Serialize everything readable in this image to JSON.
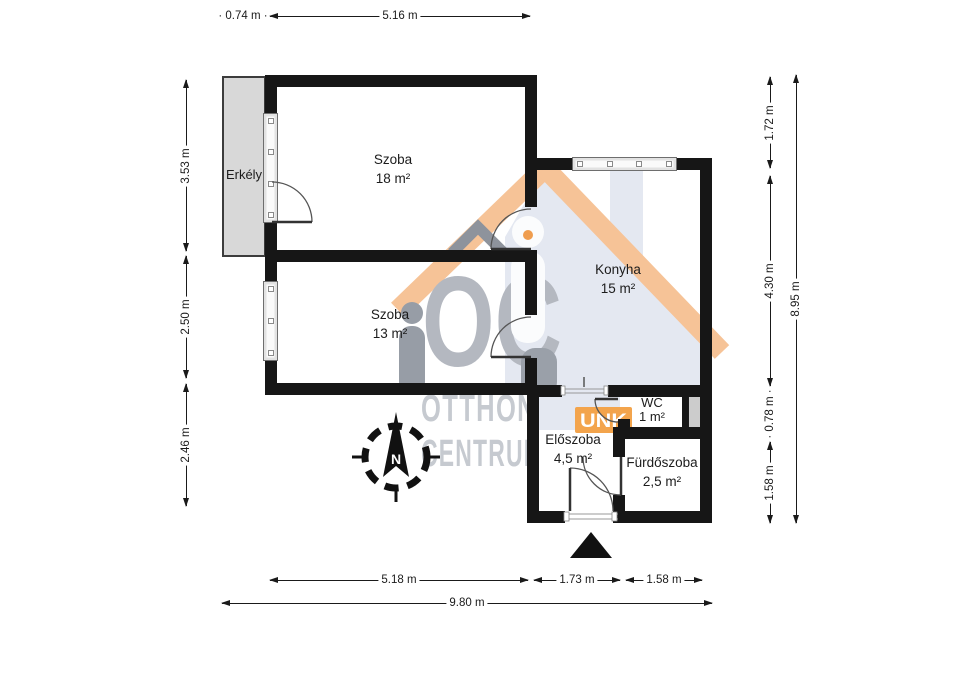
{
  "floorplan": {
    "rooms": [
      {
        "name": "Szoba",
        "area": "18 m²"
      },
      {
        "name": "Szoba",
        "area": "13 m²"
      },
      {
        "name": "Konyha",
        "area": "15 m²"
      },
      {
        "name": "WC",
        "area": "1 m²"
      },
      {
        "name": "Előszoba",
        "area": "4,5 m²"
      },
      {
        "name": "Fürdőszoba",
        "area": "2,5 m²"
      }
    ],
    "balcony_label": "Erkély",
    "compass_north": "N"
  },
  "dimensions": {
    "top": [
      "0.74 m",
      "5.16 m"
    ],
    "left": [
      "3.53 m",
      "2.50 m",
      "2.46 m"
    ],
    "right": [
      "1.72 m",
      "4.30 m",
      "0.78 m",
      "1.58 m",
      "8.95 m"
    ],
    "bottom": [
      "5.18 m",
      "1.73 m",
      "1.58 m",
      "9.80 m"
    ]
  },
  "watermark": {
    "monogram": "OC",
    "line1": "OTTHON",
    "line2": "CENTRUM",
    "badge": "UNK"
  },
  "colors": {
    "wall": "#161616",
    "balcony": "#d8d8d8",
    "shaft": "#cccccc",
    "roof_orange": "#f6c397",
    "house_fill": "#e4e8f1",
    "logo_gray": "#b4b8c0",
    "text_gray": "#c6cad0",
    "badge_orange": "#f3a44c"
  }
}
